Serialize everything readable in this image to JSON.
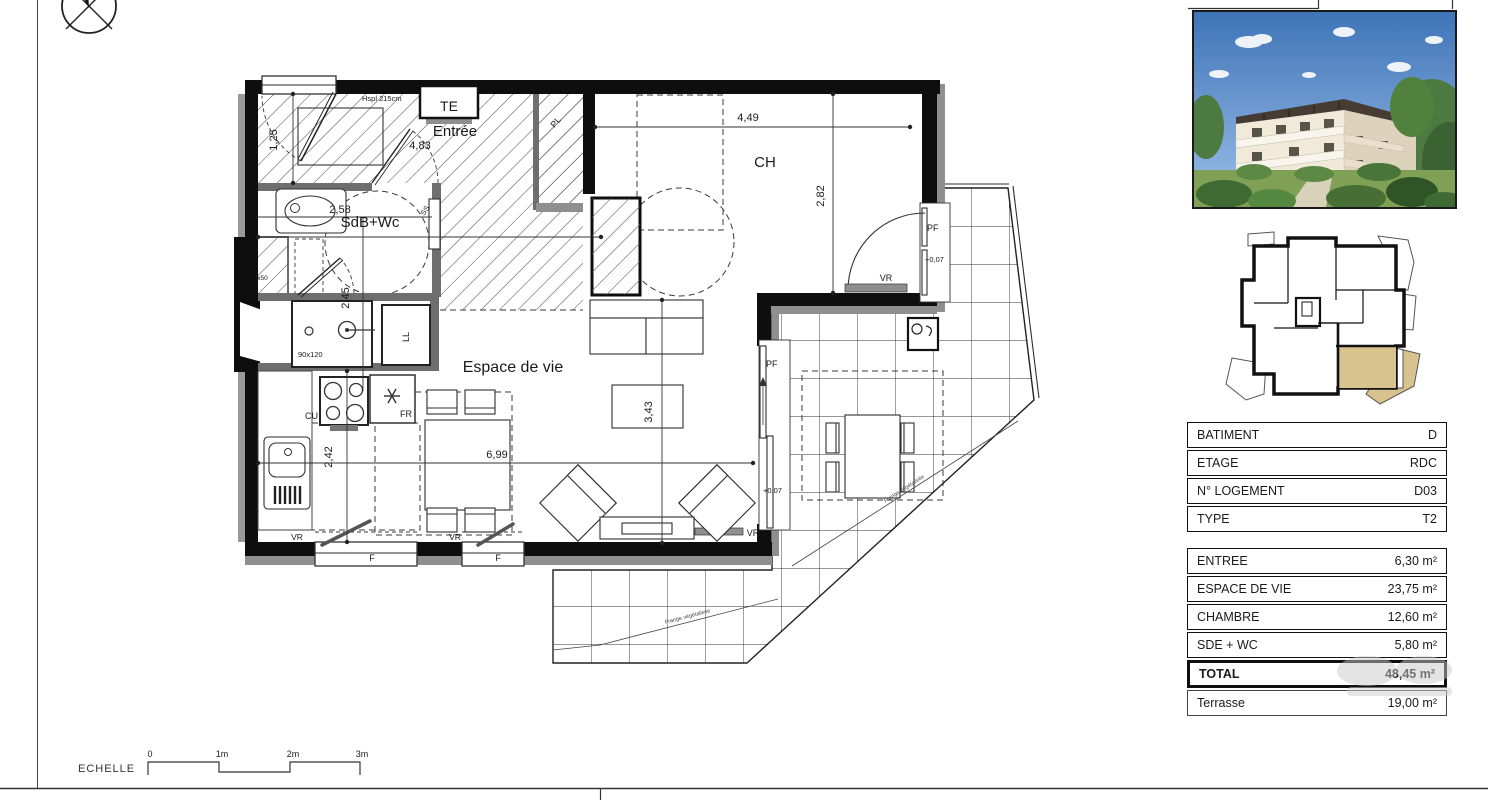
{
  "plan": {
    "rooms": {
      "entrance": "Entrée",
      "bedroom": "CH",
      "bathroom": "SdB+Wc",
      "living": "Espace de vie"
    },
    "dims": {
      "d483": "4,83",
      "d125": "1,25",
      "d258": "2,58",
      "d245": "2,45",
      "d449": "4,49",
      "d282": "2,82",
      "d699": "6,99",
      "d343": "3,43",
      "d242": "2,42"
    },
    "labels": {
      "te": "TE",
      "pl": "PL",
      "ss": "SS",
      "ll": "LL",
      "cu": "CU",
      "fr": "FR",
      "pf": "PF",
      "vr": "VR",
      "f": "F",
      "level": "+0,07",
      "shower": "90x120",
      "duct": "70x50",
      "ceiling": "Hspl 215cm"
    },
    "annotations": {
      "upper": "Frange végétalisée",
      "lower": "Frange végétalisée"
    }
  },
  "scale": {
    "label": "ECHELLE",
    "ticks": [
      "0",
      "1m",
      "2m",
      "3m"
    ]
  },
  "panel": {
    "info_rows": [
      {
        "label": "BATIMENT",
        "value": "D"
      },
      {
        "label": "ETAGE",
        "value": "RDC"
      },
      {
        "label": "N° LOGEMENT",
        "value": "D03"
      },
      {
        "label": "TYPE",
        "value": "T2"
      }
    ],
    "area_rows": [
      {
        "label": "ENTREE",
        "value": "6,30 m²"
      },
      {
        "label": "ESPACE DE VIE",
        "value": "23,75 m²"
      },
      {
        "label": "CHAMBRE",
        "value": "12,60 m²"
      },
      {
        "label": "SDE + WC",
        "value": "5,80 m²"
      }
    ],
    "total": {
      "label": "TOTAL",
      "value": "48,45 m²"
    },
    "terrace": {
      "label": "Terrasse",
      "value": "19,00 m²"
    },
    "highlight_color": "#d8c28e"
  }
}
